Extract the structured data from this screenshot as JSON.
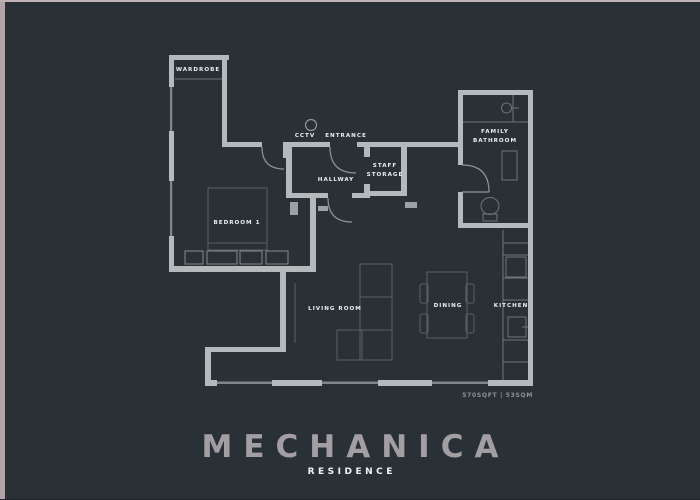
{
  "frame": {
    "border_color": "#b2a5a8",
    "background": "#2a3136"
  },
  "plan": {
    "labels": {
      "wardrobe": "WARDROBE",
      "bedroom": "BEDROOM 1",
      "cctv": "CCTV",
      "entrance": "ENTRANCE",
      "hallway": "HALLWAY",
      "staff_line1": "STAFF",
      "staff_line2": "STORAGE",
      "bathroom_line1": "FAMILY",
      "bathroom_line2": "BATHROOM",
      "living_room": "LIVING ROOM",
      "dining": "DINING",
      "kitchen": "KITCHEN"
    },
    "area": "570SQFT | 53SQM",
    "colors": {
      "wall": "#b5b9bb",
      "window": "#80878a",
      "furniture": "#596165",
      "fixture": "#6d7579",
      "door_arc": "#8f969a",
      "room_label": "#eef0f0",
      "area_label": "#8b9296"
    }
  },
  "branding": {
    "title": "MECHANICA",
    "subtitle": "RESIDENCE",
    "title_color": "#a39ea1",
    "subtitle_color": "#f2f3f4"
  }
}
